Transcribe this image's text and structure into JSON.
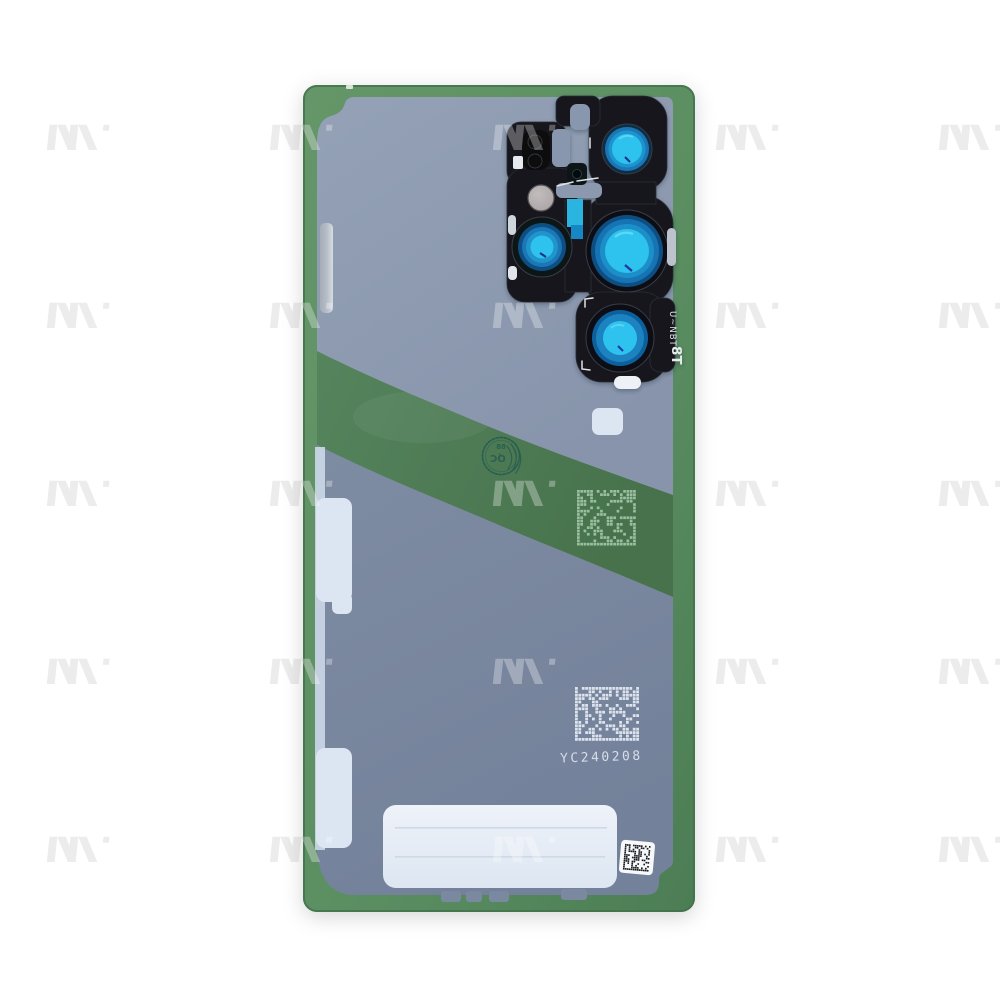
{
  "markings": {
    "camera_engraving_line1": "U~NBT",
    "camera_engraving_line2": "8T",
    "qc_stamp_text": "QC",
    "qc_stamp_number": "88",
    "etched_serial": "YC240208"
  },
  "icons": {
    "watermark": "brand-m-logo-watermark",
    "qc_stamp": "qc-inspection-stamp",
    "datamatrix_on_band": "datamatrix-code",
    "datamatrix_on_liner": "datamatrix-code",
    "datamatrix_sticker": "datamatrix-sticker"
  },
  "colors": {
    "background_white": "#ffffff",
    "glass_green_light": "#659669",
    "glass_green": "#5b8f62",
    "glass_green_dark": "#4c7d54",
    "band_green": "#55845d",
    "band_green_dark": "#47724c",
    "liner_top_light": "#94a1b6",
    "liner_top": "#8794ab",
    "liner_bottom": "#7e8ca3",
    "liner_bottom_dark": "#74819a",
    "module_black": "#16191e",
    "lens_cyan": "#2fc3ee",
    "lens_blue": "#1a76b6",
    "lens_deep_blue": "#0e4f82",
    "teal_strip": "#2cb5e0",
    "laser_grey": "#a8a2a4",
    "tab_light": "#dce5f2",
    "tab_silver": "#b5bcc6",
    "strip_light": "#ccd8e8",
    "label_white_light": "#eef2f9",
    "label_white": "#dde6f2",
    "sticker_white": "#f6f8fa",
    "dm_green": "#a3c6a8",
    "dm_light": "#e2e8f1",
    "dm_black": "#17191d",
    "stamp_teal": "#245c50",
    "serial_light": "#dbe2ec",
    "engraving_white": "#e8eaee",
    "watermark_grey": "#ececec"
  }
}
